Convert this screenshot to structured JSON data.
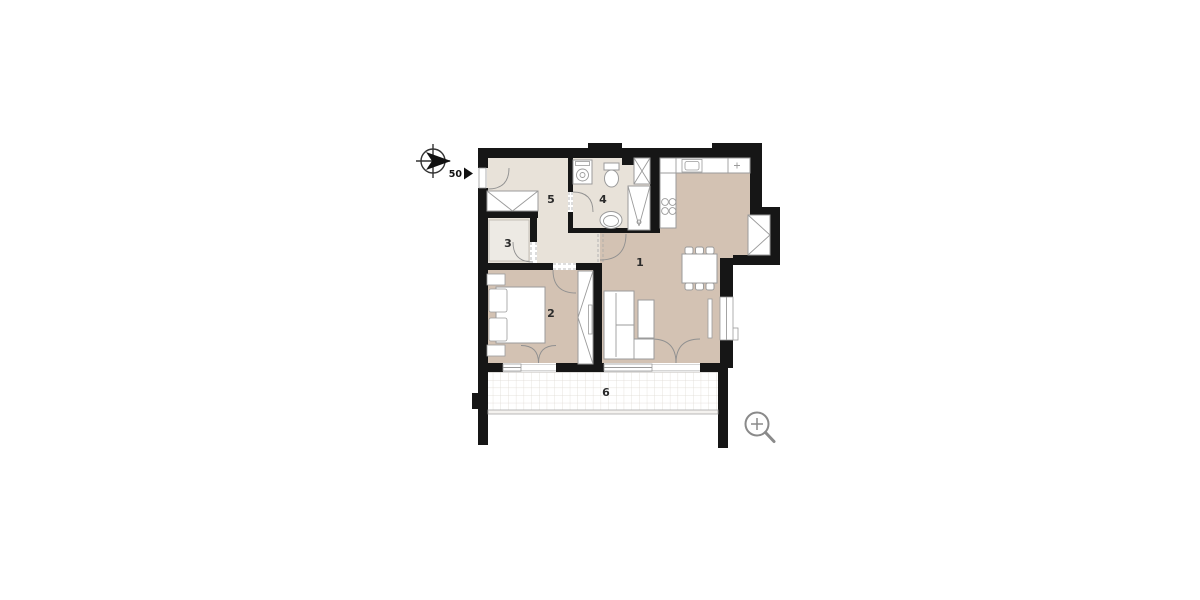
{
  "canvas": {
    "background": "#ffffff"
  },
  "floor_plan": {
    "rooms": {
      "r1": {
        "label": "1"
      },
      "r2": {
        "label": "2"
      },
      "r3": {
        "label": "3"
      },
      "r4": {
        "label": "4"
      },
      "r5": {
        "label": "5"
      },
      "r6": {
        "label": "6"
      }
    },
    "entrance_marker": {
      "label": "50"
    },
    "colors": {
      "wall": "#161616",
      "floor_main": "#d3c2b3",
      "floor_light": "#e8e2d9",
      "floor_highlight": "#edeae4",
      "furniture_stroke": "#9b9b9b",
      "door_arc": "#909090",
      "grid_line": "#ddd8d1",
      "icon_gray": "#8a8a8a",
      "label_color": "#2b2b2b"
    },
    "icons": {
      "compass": "compass-icon",
      "entrance_arrow": "entrance-arrow-icon",
      "zoom": "zoom-in-icon"
    }
  }
}
